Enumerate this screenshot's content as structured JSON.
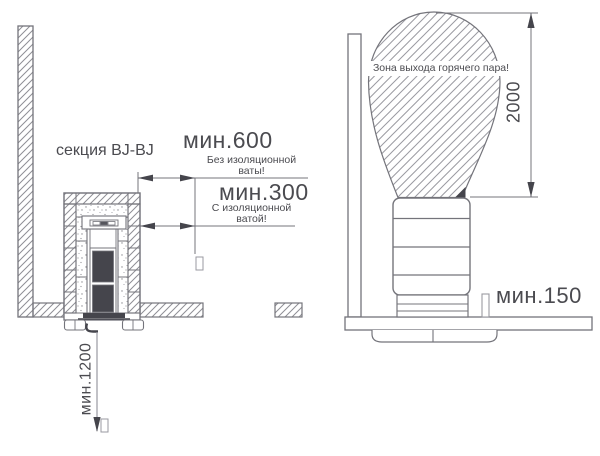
{
  "diagram": {
    "left_view": {
      "section_label": "секция BJ-BJ",
      "dim_600": {
        "value": "мин.600",
        "note_line1": "Без изоляционной",
        "note_line2": "ваты!"
      },
      "dim_300": {
        "value": "мин.300",
        "note_line1": "С изоляционной",
        "note_line2": "ватой!"
      },
      "dim_1200": {
        "value": "мин.1200"
      }
    },
    "right_view": {
      "steam_zone_label": "Зона выхода горячего пара!",
      "dim_2000": {
        "value": "2000"
      },
      "dim_150": {
        "value": "мин.150"
      }
    },
    "colors": {
      "line": "#74747b",
      "hatch": "#8e8e95",
      "dark_fill": "#45454c",
      "text": "#4b4b50",
      "background": "#ffffff"
    }
  }
}
